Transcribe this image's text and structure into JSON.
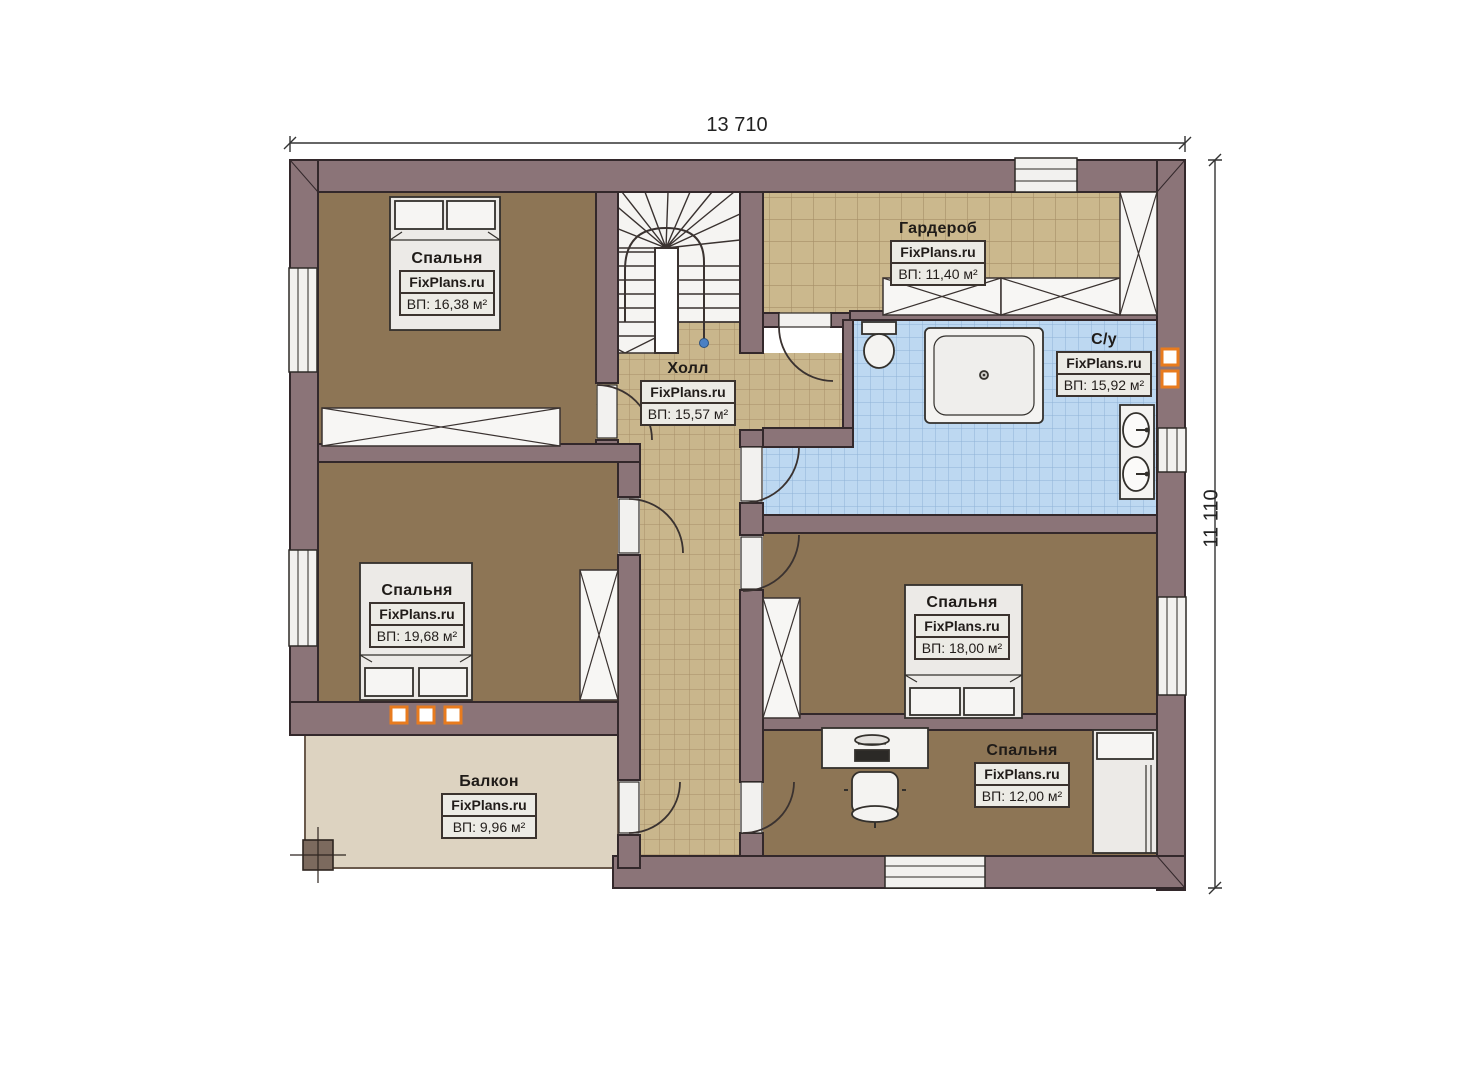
{
  "dimensions": {
    "width_label": "13 710",
    "height_label": "11 110"
  },
  "rooms": [
    {
      "id": "bedroom-top-left",
      "name": "Спальня",
      "brand": "FixPlans.ru",
      "area": "ВП: 16,38 м²"
    },
    {
      "id": "wardrobe",
      "name": "Гардероб",
      "brand": "FixPlans.ru",
      "area": "ВП: 11,40 м²"
    },
    {
      "id": "bathroom",
      "name": "С/у",
      "brand": "FixPlans.ru",
      "area": "ВП: 15,92 м²"
    },
    {
      "id": "hall",
      "name": "Холл",
      "brand": "FixPlans.ru",
      "area": "ВП: 15,57 м²"
    },
    {
      "id": "bedroom-mid-left",
      "name": "Спальня",
      "brand": "FixPlans.ru",
      "area": "ВП: 19,68 м²"
    },
    {
      "id": "bedroom-mid-right",
      "name": "Спальня",
      "brand": "FixPlans.ru",
      "area": "ВП: 18,00 м²"
    },
    {
      "id": "bedroom-bottom-right",
      "name": "Спальня",
      "brand": "FixPlans.ru",
      "area": "ВП: 12,00 м²"
    },
    {
      "id": "balcony",
      "name": "Балкон",
      "brand": "FixPlans.ru",
      "area": "ВП: 9,96 м²"
    }
  ],
  "colors": {
    "wall": "#8b7478",
    "wall_outline": "#33282b",
    "floor_brown": "#8d7555",
    "tile_beige": "#cbb88d",
    "tile_blue": "#bdd8f1",
    "balcony_floor": "#ddd3c1",
    "accent_orange": "#e87b1e"
  }
}
